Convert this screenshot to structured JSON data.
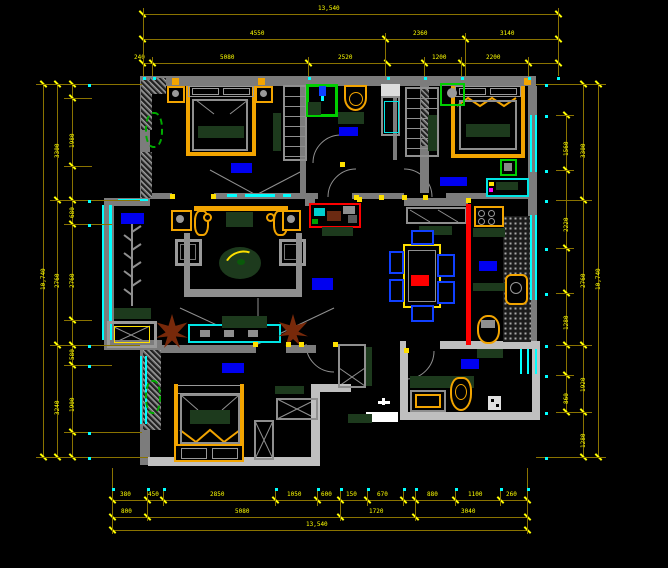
{
  "drawing": {
    "type": "cad-floor-plan",
    "style": "autocad-dark",
    "colors": {
      "background": "#000000",
      "wall": "#7c7c7c",
      "wall_light": "#bfbfbf",
      "dimension_line": "#8a7300",
      "dimension_text": "#ffff00",
      "window": "#00ffff",
      "furniture_accent": "#f2a400",
      "textile": "#1d3a1d",
      "label_block": "#0000f0",
      "highlight_red": "#ff0000",
      "chair_blue": "#1040ff",
      "plant_green": "#00cf00",
      "plant_brown": "#78290a"
    }
  },
  "dimensions": [
    {
      "orient": "h",
      "y": 14,
      "x1": 142,
      "x2": 558,
      "ticks": [
        142,
        558
      ],
      "labels": [
        {
          "t": "13,540",
          "x": 318
        }
      ]
    },
    {
      "orient": "h",
      "y": 39,
      "x1": 142,
      "x2": 558,
      "ticks": [
        142,
        385,
        465,
        558
      ],
      "labels": [
        {
          "t": "4550",
          "x": 250
        },
        {
          "t": "2360",
          "x": 413
        },
        {
          "t": "3140",
          "x": 500
        }
      ]
    },
    {
      "orient": "h",
      "y": 63,
      "x1": 142,
      "x2": 558,
      "ticks": [
        142,
        152,
        308,
        387,
        424,
        461,
        528,
        558
      ],
      "labels": [
        {
          "t": "240",
          "x": 134
        },
        {
          "t": "5080",
          "x": 220
        },
        {
          "t": "2520",
          "x": 338
        },
        {
          "t": "1200",
          "x": 432
        },
        {
          "t": "2200",
          "x": 486
        }
      ]
    },
    {
      "orient": "h",
      "y": 500,
      "x1": 112,
      "x2": 527,
      "ticks": [
        112,
        147,
        163,
        275,
        317,
        340,
        367,
        403,
        415,
        455,
        500,
        527
      ],
      "labels": [
        {
          "t": "380",
          "x": 120
        },
        {
          "t": "450",
          "x": 148
        },
        {
          "t": "2850",
          "x": 210
        },
        {
          "t": "1050",
          "x": 287
        },
        {
          "t": "600",
          "x": 321
        },
        {
          "t": "150",
          "x": 346
        },
        {
          "t": "670",
          "x": 377
        },
        {
          "t": "880",
          "x": 427
        },
        {
          "t": "1100",
          "x": 468
        },
        {
          "t": "260",
          "x": 506
        }
      ]
    },
    {
      "orient": "h",
      "y": 517,
      "x1": 112,
      "x2": 527,
      "ticks": [
        112,
        147,
        340,
        415,
        527
      ],
      "labels": [
        {
          "t": "800",
          "x": 121
        },
        {
          "t": "5080",
          "x": 235
        },
        {
          "t": "1720",
          "x": 369
        },
        {
          "t": "3040",
          "x": 461
        }
      ]
    },
    {
      "orient": "h",
      "y": 530,
      "x1": 112,
      "x2": 527,
      "ticks": [
        112,
        527
      ],
      "labels": [
        {
          "t": "13,540",
          "x": 306
        }
      ]
    },
    {
      "orient": "v",
      "x": 43,
      "y1": 84,
      "y2": 457,
      "ticks": [
        84,
        457
      ],
      "labels": [
        {
          "t": "10,740",
          "y": 290
        }
      ]
    },
    {
      "orient": "v",
      "x": 57,
      "y1": 84,
      "y2": 457,
      "ticks": [
        84,
        200,
        345,
        457
      ],
      "labels": [
        {
          "t": "3300",
          "y": 158
        },
        {
          "t": "2760",
          "y": 288
        },
        {
          "t": "3240",
          "y": 415
        }
      ]
    },
    {
      "orient": "v",
      "x": 72,
      "y1": 84,
      "y2": 457,
      "ticks": [
        84,
        98,
        166,
        200,
        224,
        320,
        345,
        365,
        432,
        457
      ],
      "labels": [
        {
          "t": "1980",
          "y": 148
        },
        {
          "t": "680",
          "y": 218
        },
        {
          "t": "2760",
          "y": 288
        },
        {
          "t": "580",
          "y": 360
        },
        {
          "t": "1900",
          "y": 412
        }
      ]
    },
    {
      "orient": "v",
      "x": 598,
      "y1": 84,
      "y2": 457,
      "ticks": [
        84,
        457
      ],
      "labels": [
        {
          "t": "10,740",
          "y": 290
        }
      ]
    },
    {
      "orient": "v",
      "x": 583,
      "y1": 84,
      "y2": 457,
      "ticks": [
        84,
        200,
        345,
        412,
        457
      ],
      "labels": [
        {
          "t": "3300",
          "y": 158
        },
        {
          "t": "2760",
          "y": 288
        },
        {
          "t": "1920",
          "y": 392
        },
        {
          "t": "1280",
          "y": 448
        }
      ]
    },
    {
      "orient": "v",
      "x": 566,
      "y1": 115,
      "y2": 412,
      "ticks": [
        115,
        170,
        248,
        293,
        345,
        375,
        412
      ],
      "labels": [
        {
          "t": "1560",
          "y": 156
        },
        {
          "t": "2220",
          "y": 232
        },
        {
          "t": "1280",
          "y": 330
        },
        {
          "t": "860",
          "y": 404
        }
      ]
    }
  ],
  "extensions": [
    {
      "x": 143,
      "y": 8,
      "w": 1,
      "h": 68
    },
    {
      "x": 558,
      "y": 8,
      "w": 1,
      "h": 68
    },
    {
      "x": 385,
      "y": 33,
      "w": 1,
      "h": 43
    },
    {
      "x": 465,
      "y": 33,
      "w": 1,
      "h": 43
    },
    {
      "x": 152,
      "y": 57,
      "w": 1,
      "h": 19
    },
    {
      "x": 308,
      "y": 57,
      "w": 1,
      "h": 19
    },
    {
      "x": 424,
      "y": 57,
      "w": 1,
      "h": 19
    },
    {
      "x": 461,
      "y": 57,
      "w": 1,
      "h": 19
    },
    {
      "x": 528,
      "y": 57,
      "w": 1,
      "h": 19
    },
    {
      "x": 36,
      "y": 84,
      "w": 106,
      "h": 1
    },
    {
      "x": 50,
      "y": 200,
      "w": 90,
      "h": 1
    },
    {
      "x": 64,
      "y": 224,
      "w": 48,
      "h": 1
    },
    {
      "x": 50,
      "y": 345,
      "w": 90,
      "h": 1
    },
    {
      "x": 64,
      "y": 365,
      "w": 48,
      "h": 1
    },
    {
      "x": 64,
      "y": 432,
      "w": 78,
      "h": 1
    },
    {
      "x": 36,
      "y": 457,
      "w": 112,
      "h": 1
    },
    {
      "x": 64,
      "y": 98,
      "w": 28,
      "h": 1
    },
    {
      "x": 64,
      "y": 166,
      "w": 28,
      "h": 1
    },
    {
      "x": 64,
      "y": 320,
      "w": 28,
      "h": 1
    },
    {
      "x": 536,
      "y": 84,
      "w": 70,
      "h": 1
    },
    {
      "x": 536,
      "y": 457,
      "w": 70,
      "h": 1
    },
    {
      "x": 556,
      "y": 200,
      "w": 36,
      "h": 1
    },
    {
      "x": 556,
      "y": 345,
      "w": 36,
      "h": 1
    },
    {
      "x": 556,
      "y": 412,
      "w": 36,
      "h": 1
    },
    {
      "x": 556,
      "y": 115,
      "w": 18,
      "h": 1
    },
    {
      "x": 556,
      "y": 170,
      "w": 18,
      "h": 1
    },
    {
      "x": 556,
      "y": 248,
      "w": 18,
      "h": 1
    },
    {
      "x": 556,
      "y": 293,
      "w": 18,
      "h": 1
    },
    {
      "x": 556,
      "y": 375,
      "w": 18,
      "h": 1
    },
    {
      "x": 112,
      "y": 468,
      "w": 1,
      "h": 66
    },
    {
      "x": 527,
      "y": 468,
      "w": 1,
      "h": 66
    },
    {
      "x": 147,
      "y": 490,
      "w": 1,
      "h": 31
    },
    {
      "x": 340,
      "y": 490,
      "w": 1,
      "h": 31
    },
    {
      "x": 415,
      "y": 490,
      "w": 1,
      "h": 31
    },
    {
      "x": 163,
      "y": 490,
      "w": 1,
      "h": 16
    },
    {
      "x": 275,
      "y": 490,
      "w": 1,
      "h": 16
    },
    {
      "x": 317,
      "y": 490,
      "w": 1,
      "h": 16
    },
    {
      "x": 367,
      "y": 490,
      "w": 1,
      "h": 16
    },
    {
      "x": 403,
      "y": 490,
      "w": 1,
      "h": 16
    },
    {
      "x": 455,
      "y": 490,
      "w": 1,
      "h": 16
    },
    {
      "x": 500,
      "y": 490,
      "w": 1,
      "h": 16
    }
  ],
  "cyan_dots": [
    [
      143,
      77
    ],
    [
      153,
      77
    ],
    [
      308,
      77
    ],
    [
      387,
      77
    ],
    [
      424,
      77
    ],
    [
      461,
      77
    ],
    [
      528,
      77
    ],
    [
      557,
      77
    ],
    [
      112,
      488
    ],
    [
      147,
      488
    ],
    [
      163,
      488
    ],
    [
      275,
      488
    ],
    [
      317,
      488
    ],
    [
      340,
      488
    ],
    [
      367,
      488
    ],
    [
      403,
      488
    ],
    [
      415,
      488
    ],
    [
      455,
      488
    ],
    [
      500,
      488
    ],
    [
      527,
      488
    ],
    [
      88,
      84
    ],
    [
      88,
      200
    ],
    [
      88,
      224
    ],
    [
      88,
      345
    ],
    [
      88,
      365
    ],
    [
      88,
      432
    ],
    [
      88,
      457
    ],
    [
      545,
      84
    ],
    [
      545,
      115
    ],
    [
      545,
      170
    ],
    [
      545,
      200
    ],
    [
      545,
      248
    ],
    [
      545,
      293
    ],
    [
      545,
      345
    ],
    [
      545,
      375
    ],
    [
      545,
      412
    ],
    [
      545,
      457
    ]
  ],
  "door_hinges": [
    [
      170,
      194
    ],
    [
      211,
      194
    ],
    [
      340,
      162
    ],
    [
      354,
      195
    ],
    [
      379,
      195
    ],
    [
      402,
      195
    ],
    [
      423,
      195
    ],
    [
      357,
      197
    ],
    [
      253,
      342
    ],
    [
      286,
      342
    ],
    [
      299,
      342
    ],
    [
      333,
      342
    ],
    [
      404,
      348
    ],
    [
      466,
      198
    ]
  ],
  "room_label_blocks": [
    {
      "name": "label-balcony",
      "x": 121,
      "y": 213,
      "w": 23,
      "h": 11
    },
    {
      "name": "label-living-room",
      "x": 312,
      "y": 278,
      "w": 21,
      "h": 12
    },
    {
      "name": "label-bedroom-1",
      "x": 231,
      "y": 163,
      "w": 21,
      "h": 10
    },
    {
      "name": "label-bathroom-1",
      "x": 339,
      "y": 127,
      "w": 19,
      "h": 9
    },
    {
      "name": "label-bedroom-2",
      "x": 440,
      "y": 177,
      "w": 27,
      "h": 9
    },
    {
      "name": "label-kitchen",
      "x": 479,
      "y": 261,
      "w": 18,
      "h": 10
    },
    {
      "name": "label-bedroom-3",
      "x": 222,
      "y": 363,
      "w": 22,
      "h": 10
    },
    {
      "name": "label-bathroom-2",
      "x": 461,
      "y": 359,
      "w": 18,
      "h": 10
    }
  ]
}
